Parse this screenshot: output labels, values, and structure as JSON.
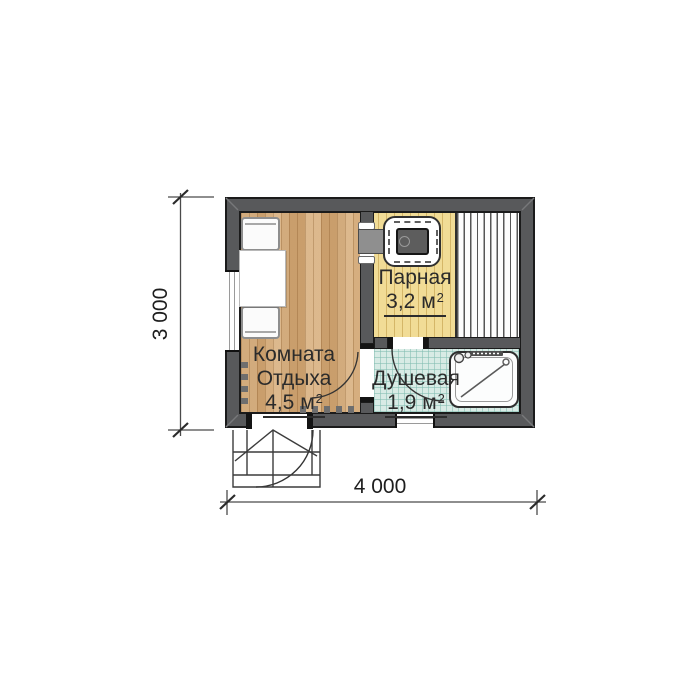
{
  "rooms": [
    {
      "lines": [
        "Комната",
        "Отдыха"
      ],
      "area": "4,5"
    },
    {
      "lines": [
        "Парная"
      ],
      "area": "3,2"
    },
    {
      "lines": [
        "Душевая"
      ],
      "area": "1,9"
    }
  ],
  "area_unit": {
    "letter": "м",
    "superscript": "2"
  },
  "dimensions": {
    "height_mm": "3 000",
    "width_mm": "4 000"
  },
  "fixtures": {
    "stove": "sauna-stove",
    "sauna_bench": "sauna-bench-platform",
    "shower_tray": "shower-tray",
    "table": "rest-room-table",
    "benches": "rest-room-bench-seats",
    "porch": "entrance-steps",
    "door_arcs": "door-swing-arc",
    "windows": "window"
  },
  "colors": {
    "wall": "#58595b",
    "outline": "#1b1b1b",
    "wood_floor": "#d3a875",
    "sauna_floor": "#f1dc96",
    "tile_floor": "#d8ebe5",
    "bench_stripes": "#565656",
    "linework": "#3c3c3c"
  }
}
